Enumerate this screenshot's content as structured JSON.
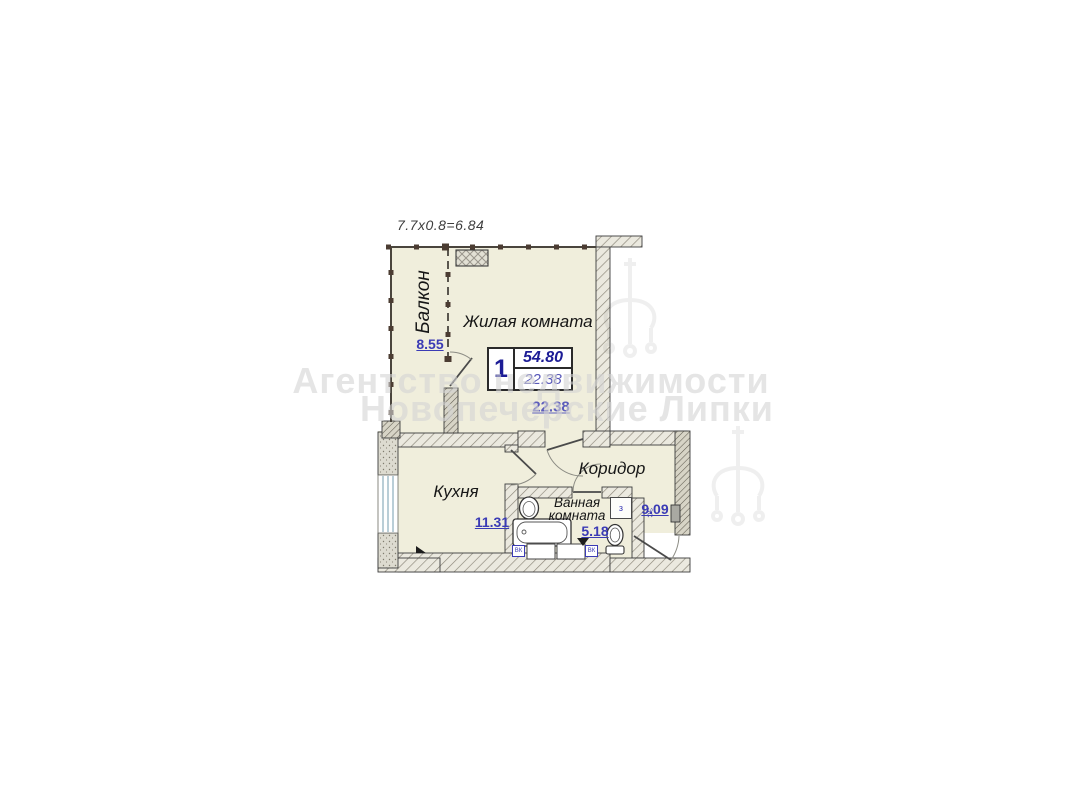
{
  "dimension_note": "7.7х0.8=6.84",
  "watermark": {
    "line1": "Агентство недвижимости",
    "line2": "Новопечерские Липки"
  },
  "stat_box": {
    "room_count": "1",
    "total_area": "54.80",
    "living_area": "22.38"
  },
  "rooms": {
    "balcony": {
      "name": "Балкон",
      "area": "8.55"
    },
    "living": {
      "name": "Жилая комната",
      "area": "22.38"
    },
    "kitchen": {
      "name": "Кухня",
      "area": "11.31"
    },
    "corridor": {
      "name": "Коридор",
      "area": "9.09"
    },
    "bathroom": {
      "name_line1": "Ванная",
      "name_line2": "комната",
      "area": "5.18"
    }
  },
  "annotations": {
    "meter_left": "ВК",
    "meter_right": "ВК",
    "shaft": "з",
    "panel": "ЭС"
  },
  "colors": {
    "room_fill": "#f0eedc",
    "value_blue": "#3b3bb5",
    "stat_blue": "#1c1c96",
    "wall_line": "#3c3c3c"
  }
}
